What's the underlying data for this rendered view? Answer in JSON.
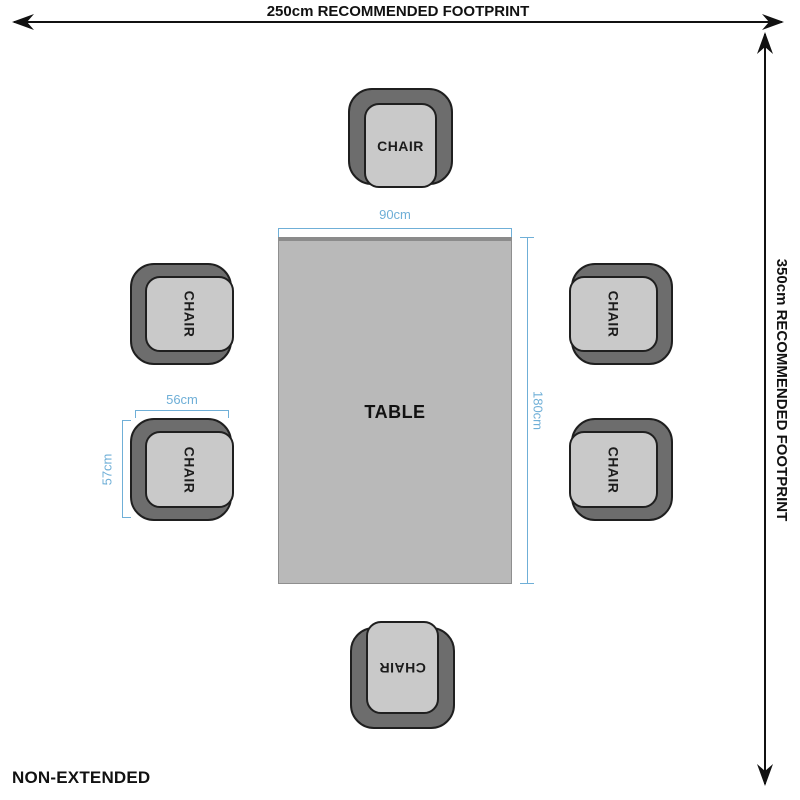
{
  "diagram": {
    "top_footprint_label": "250cm RECOMMENDED FOOTPRINT",
    "right_footprint_label": "350cm RECOMMENDED FOOTPRINT",
    "variant_label": "NON-EXTENDED"
  },
  "table": {
    "label": "TABLE",
    "width_dim": "90cm",
    "depth_dim": "180cm"
  },
  "chair_dims": {
    "width_dim": "56cm",
    "depth_dim": "57cm"
  },
  "chairs": [
    {
      "position": "top",
      "label": "CHAIR"
    },
    {
      "position": "left-upper",
      "label": "CHAIR"
    },
    {
      "position": "left-lower",
      "label": "CHAIR"
    },
    {
      "position": "right-upper",
      "label": "CHAIR"
    },
    {
      "position": "right-lower",
      "label": "CHAIR"
    },
    {
      "position": "bottom",
      "label": "CHAIR"
    }
  ],
  "colors": {
    "dimension_accent": "#6fafd7",
    "chair_back": "#6d6d6d",
    "chair_seat": "#c9c9c9",
    "table_fill": "#b9b9b9",
    "outline": "#111111"
  }
}
